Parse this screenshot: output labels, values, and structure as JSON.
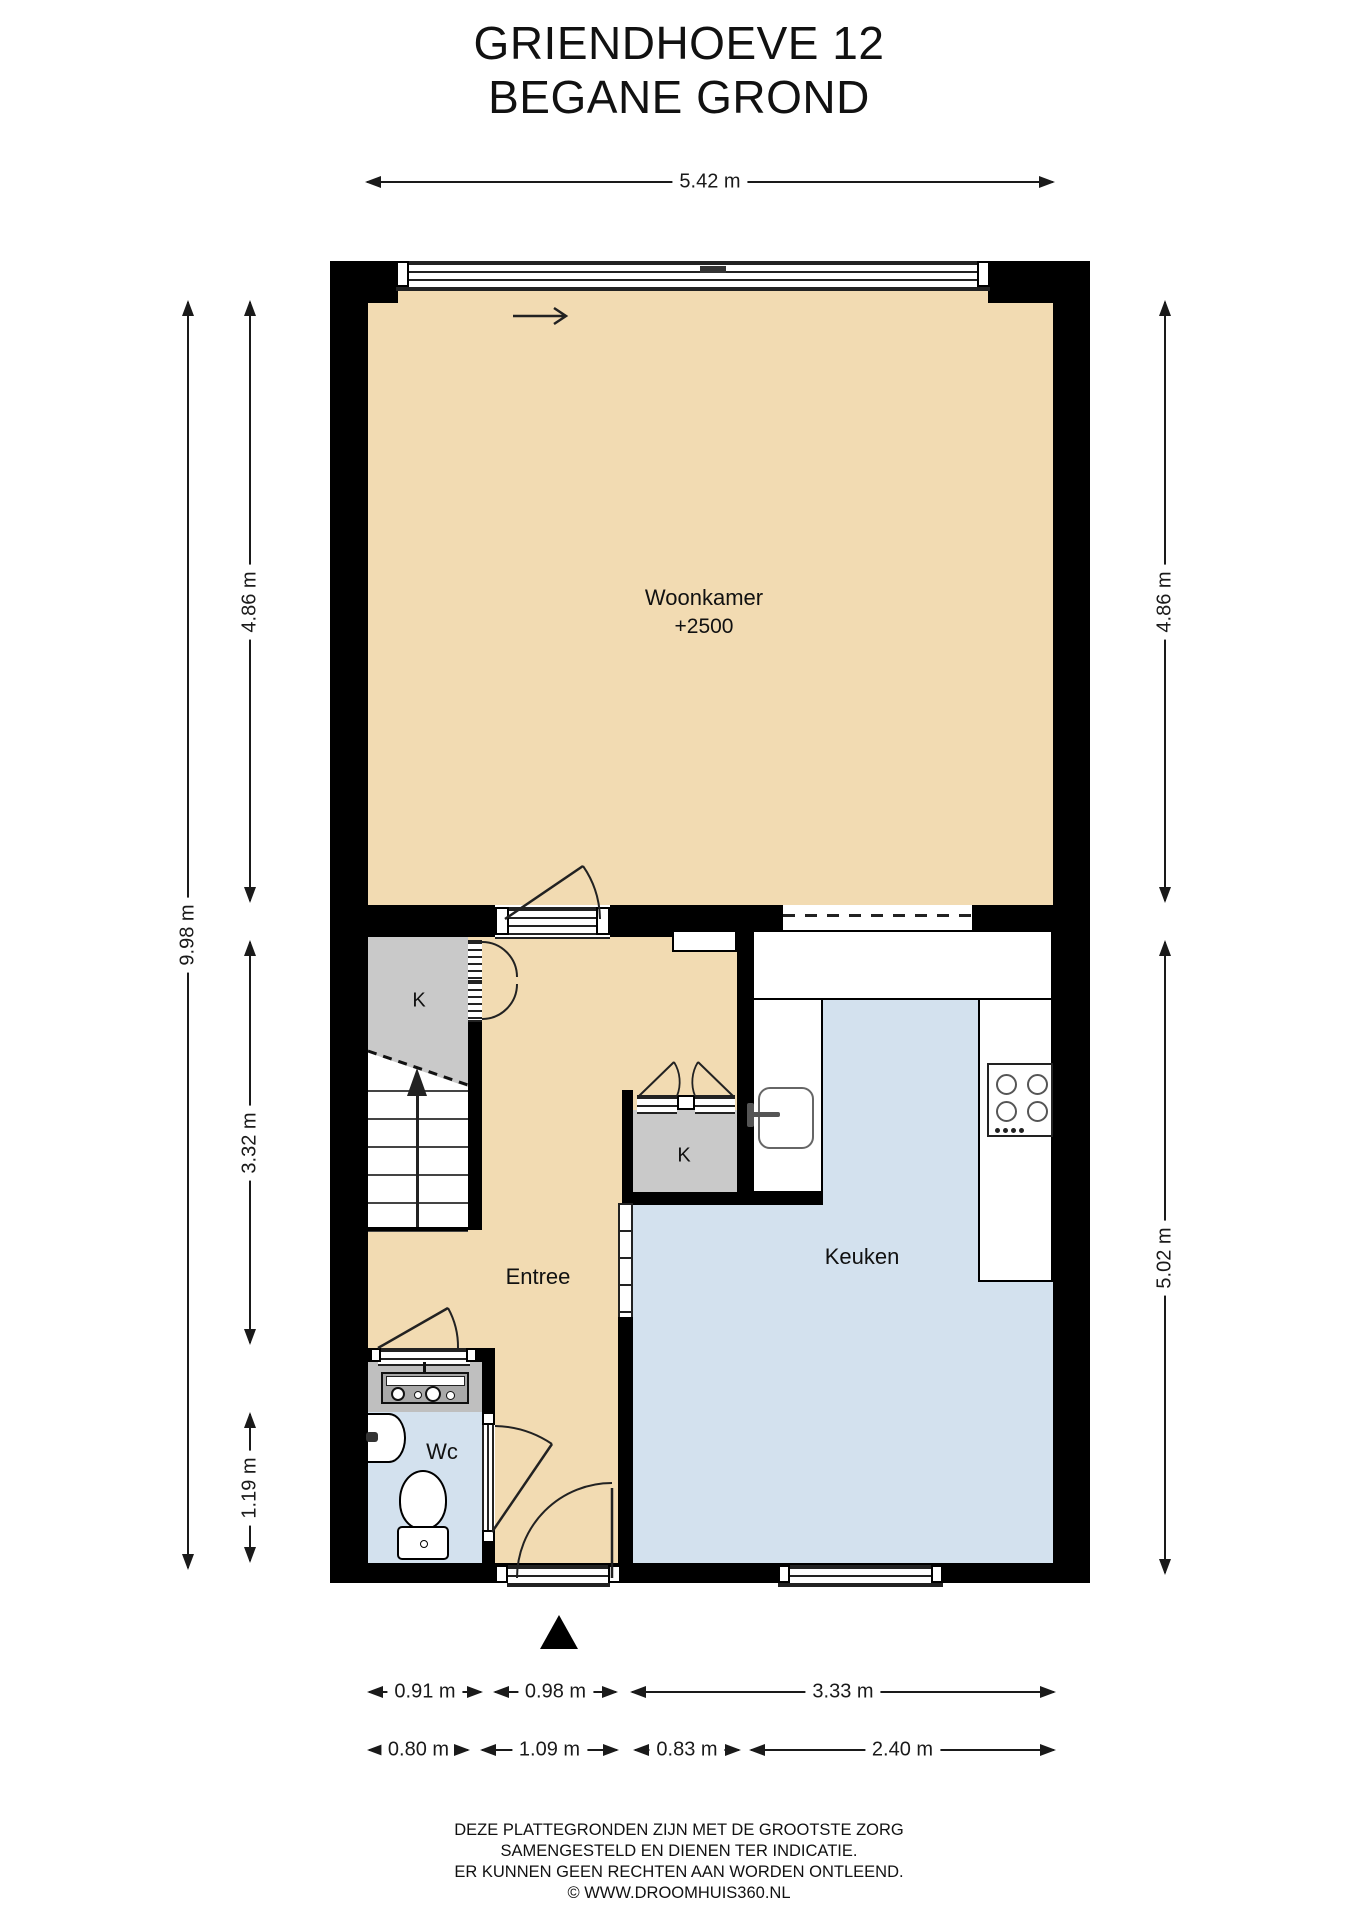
{
  "title": {
    "line1": "GRIENDHOEVE 12",
    "line2": "BEGANE GROND"
  },
  "rooms": {
    "woonkamer": {
      "name": "Woonkamer",
      "ceiling_height": "+2500"
    },
    "entree": {
      "name": "Entree"
    },
    "keuken": {
      "name": "Keuken"
    },
    "wc": {
      "name": "Wc"
    },
    "closet_under_stairs": {
      "name": "K"
    },
    "closet_hall": {
      "name": "K"
    }
  },
  "dimensions": {
    "top_width": "5.42 m",
    "left_total_height": "9.98 m",
    "left_upper": "4.86 m",
    "left_middle": "3.32 m",
    "left_lower": "1.19 m",
    "right_upper": "4.86 m",
    "right_lower": "5.02 m",
    "bottom_row1": [
      "0.91 m",
      "0.98 m",
      "3.33 m"
    ],
    "bottom_row2": [
      "0.80 m",
      "1.09 m",
      "0.83 m",
      "2.40 m"
    ]
  },
  "footer": {
    "line1": "DEZE PLATTEGRONDEN ZIJN MET DE GROOTSTE ZORG",
    "line2": "SAMENGESTELD EN DIENEN TER INDICATIE.",
    "line3": "ER KUNNEN GEEN RECHTEN AAN WORDEN ONTLEEND.",
    "line4": "© WWW.DROOMHUIS360.NL"
  },
  "colors": {
    "wall": "#000000",
    "living_floor": "#F2DBB2",
    "kitchen_floor": "#D3E1EE",
    "closet_fill": "#C9C9C9",
    "text": "#1A1A1A"
  }
}
